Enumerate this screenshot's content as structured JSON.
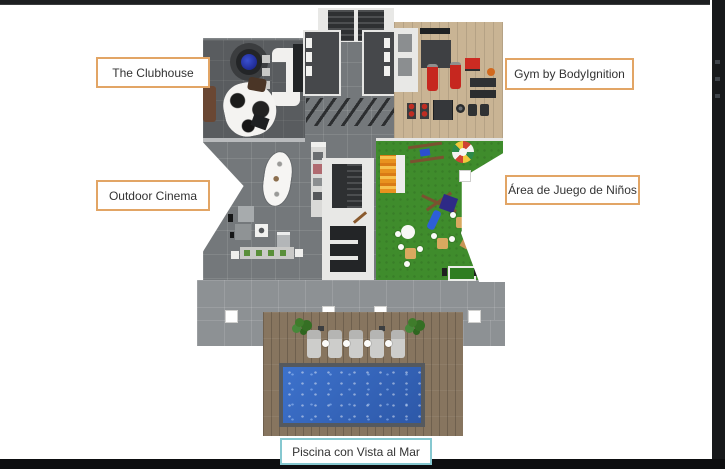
{
  "labels": {
    "clubhouse": {
      "text": "The Clubhouse",
      "border_color": "#e2a565"
    },
    "gym": {
      "text": "Gym by BodyIgnition",
      "border_color": "#e2a565"
    },
    "cinema": {
      "text": "Outdoor Cinema",
      "border_color": "#e2a565"
    },
    "kids": {
      "text": "Área de Juego de Niños",
      "border_color": "#e2a565"
    },
    "pool": {
      "text": "Piscina con Vista al Mar",
      "border_color": "#86c8d0"
    }
  },
  "colors": {
    "label_accent_orange": "#e2a565",
    "label_accent_teal": "#86c8d0",
    "pool_water_blue": "#3566bd",
    "grass_green": "#3f8c2c",
    "gym_wood": "#c9b494",
    "deck_wood": "#87755f",
    "tile_gray": "#74787b",
    "frame_dark": "#17191b"
  }
}
